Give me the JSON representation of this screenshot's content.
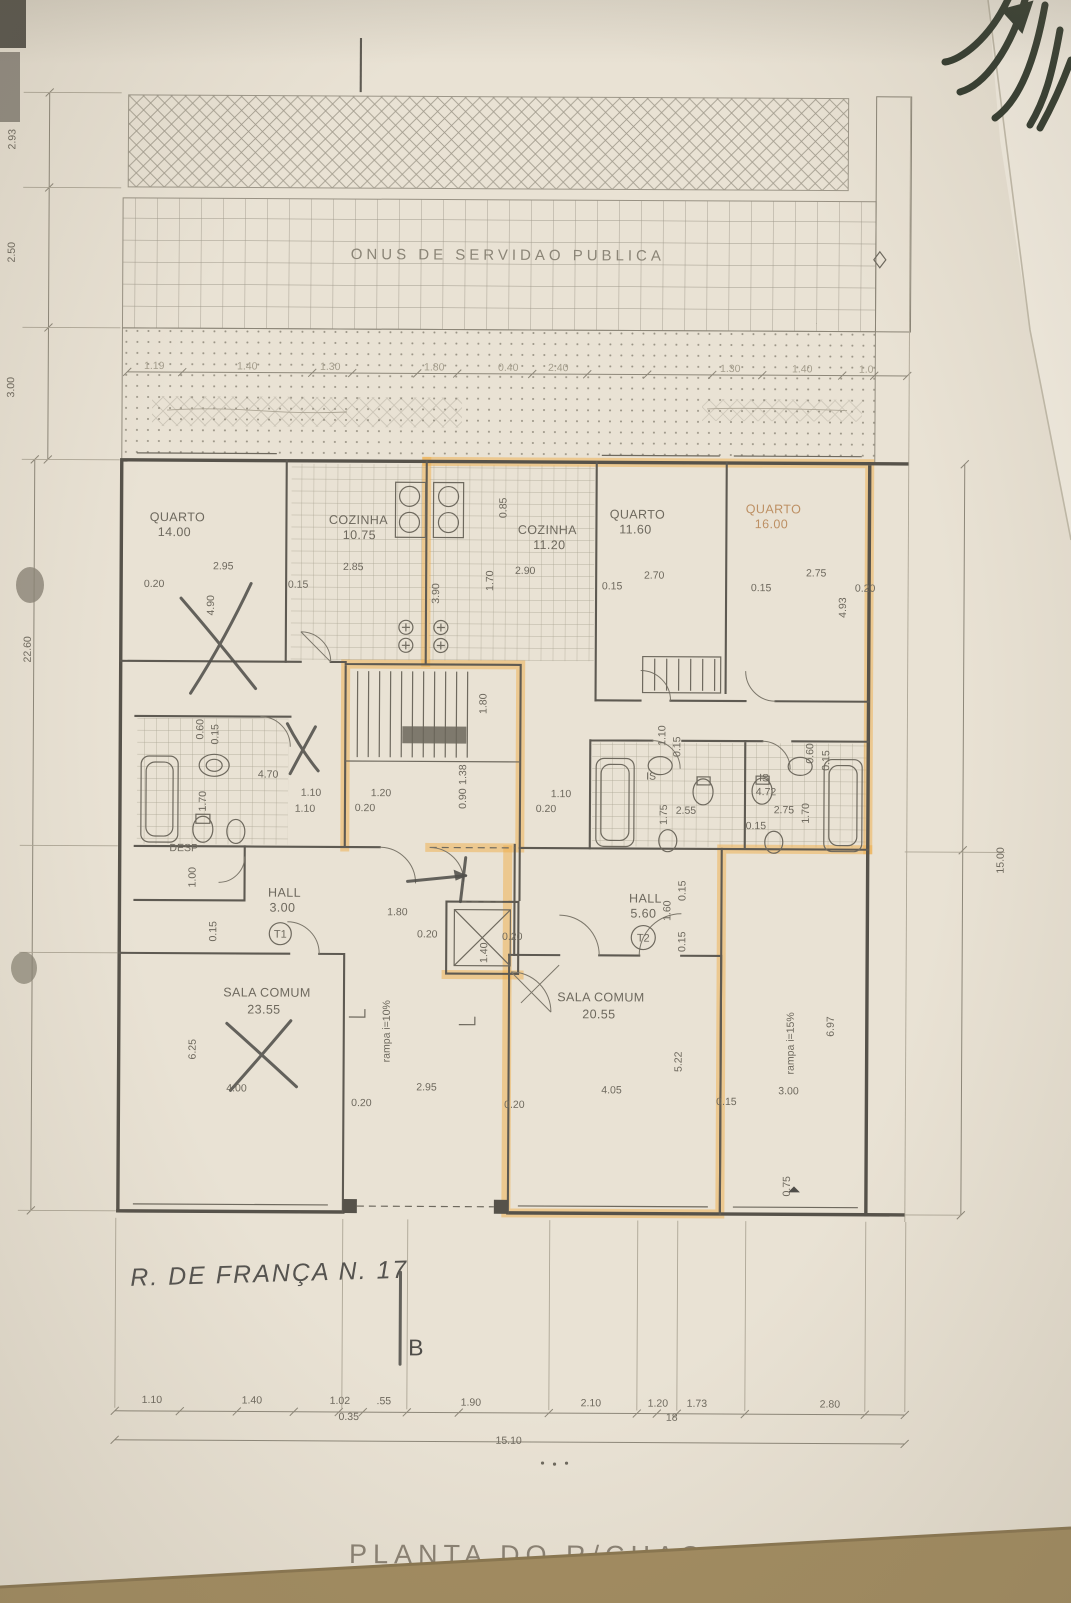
{
  "colors": {
    "paper": "#e9e2d4",
    "ink": "#6e695e",
    "wall_line": "#56524a",
    "highlighter": "#efae49",
    "pencil_mark": "#504e4a",
    "table_band": "#a28c60"
  },
  "stamps": {
    "servitude_band": "ONUS DE SERVIDAO PUBLICA",
    "sheet_title": "PLANTA DO R/CHAO"
  },
  "handwriting": {
    "street_note": "R. DE FRANÇA N. 17",
    "section_marker": "B"
  },
  "units": [
    {
      "id": "T1"
    },
    {
      "id": "T2"
    }
  ],
  "rooms": [
    {
      "name": "QUARTO",
      "area": "14.00"
    },
    {
      "name": "COZINHA",
      "area": "10.75"
    },
    {
      "name": "COZINHA",
      "area": "11.20"
    },
    {
      "name": "QUARTO",
      "area": "11.60"
    },
    {
      "name": "QUARTO",
      "area": "16.00"
    },
    {
      "name": "SALA COMUM",
      "area": "23.55"
    },
    {
      "name": "SALA COMUM",
      "area": "20.55"
    },
    {
      "name": "HALL",
      "area": "3.00"
    },
    {
      "name": "HALL",
      "area": "5.60"
    },
    {
      "name": "DESP",
      "area": ""
    },
    {
      "name": "IS",
      "area": ""
    },
    {
      "name": "IS",
      "area": "4.72"
    }
  ],
  "ramps": [
    {
      "label": "rampa i=10%"
    },
    {
      "label": "rampa i=15%"
    }
  ],
  "dimensions": {
    "totals": {
      "bottom_width": "15.10",
      "right_height": "15.00",
      "left_height": "22.60"
    },
    "chain_values": [
      {
        "t": "1.19",
        "x": 152,
        "y": 371,
        "f": 1
      },
      {
        "t": "1.40",
        "x": 245,
        "y": 371,
        "f": 1
      },
      {
        "t": "1.30",
        "x": 328,
        "y": 371,
        "f": 1
      },
      {
        "t": "1.80",
        "x": 432,
        "y": 371,
        "f": 1
      },
      {
        "t": "0.40",
        "x": 506,
        "y": 371,
        "f": 1
      },
      {
        "t": "2.40",
        "x": 556,
        "y": 371,
        "f": 1
      },
      {
        "t": "1.30",
        "x": 728,
        "y": 371,
        "f": 1
      },
      {
        "t": "1.40",
        "x": 800,
        "y": 371,
        "f": 1
      },
      {
        "t": "1.0",
        "x": 864,
        "y": 371,
        "f": 1
      },
      {
        "t": "2.93",
        "x": 12,
        "y": 142,
        "r": -90
      },
      {
        "t": "2.50",
        "x": 12,
        "y": 255,
        "r": -90
      },
      {
        "t": "3.00",
        "x": 12,
        "y": 390,
        "r": -90
      },
      {
        "t": "0.20",
        "x": 153,
        "y": 589
      },
      {
        "t": "2.95",
        "x": 222,
        "y": 571
      },
      {
        "t": "4.90",
        "x": 213,
        "y": 607,
        "r": -90
      },
      {
        "t": "0.15",
        "x": 297,
        "y": 589
      },
      {
        "t": "2.85",
        "x": 352,
        "y": 571
      },
      {
        "t": "3.90",
        "x": 438,
        "y": 594,
        "r": -90
      },
      {
        "t": "1.70",
        "x": 492,
        "y": 581,
        "r": -90
      },
      {
        "t": "2.90",
        "x": 524,
        "y": 574
      },
      {
        "t": "0.85",
        "x": 505,
        "y": 508,
        "r": -90
      },
      {
        "t": "0.15",
        "x": 611,
        "y": 589
      },
      {
        "t": "2.70",
        "x": 653,
        "y": 578
      },
      {
        "t": "2.75",
        "x": 815,
        "y": 575
      },
      {
        "t": "0.15",
        "x": 760,
        "y": 590
      },
      {
        "t": "0.20",
        "x": 864,
        "y": 590
      },
      {
        "t": "4.93",
        "x": 845,
        "y": 606,
        "r": -90
      },
      {
        "t": "0.60",
        "x": 203,
        "y": 731,
        "r": -90
      },
      {
        "t": "0.15",
        "x": 218,
        "y": 736,
        "r": -90
      },
      {
        "t": "1.70",
        "x": 206,
        "y": 803,
        "r": -90
      },
      {
        "t": "4.70",
        "x": 268,
        "y": 779
      },
      {
        "t": "1.10",
        "x": 305,
        "y": 813
      },
      {
        "t": "1.00",
        "x": 196,
        "y": 879,
        "r": -90
      },
      {
        "t": "0.15",
        "x": 217,
        "y": 933,
        "r": -90
      },
      {
        "t": "1.80",
        "x": 486,
        "y": 704,
        "r": -90
      },
      {
        "t": "1.38",
        "x": 466,
        "y": 775,
        "r": -90
      },
      {
        "t": "0.90",
        "x": 466,
        "y": 799,
        "r": -90
      },
      {
        "t": "1.20",
        "x": 381,
        "y": 797
      },
      {
        "t": "0.20",
        "x": 365,
        "y": 812
      },
      {
        "t": "1.10",
        "x": 311,
        "y": 797
      },
      {
        "t": "1.10",
        "x": 561,
        "y": 797
      },
      {
        "t": "0.20",
        "x": 546,
        "y": 812
      },
      {
        "t": "1.10",
        "x": 665,
        "y": 735,
        "r": -90
      },
      {
        "t": "0.15",
        "x": 680,
        "y": 746,
        "r": -90
      },
      {
        "t": "2.55",
        "x": 686,
        "y": 813
      },
      {
        "t": "1.75",
        "x": 667,
        "y": 814,
        "r": -90
      },
      {
        "t": "0.15",
        "x": 756,
        "y": 828
      },
      {
        "t": "2.75",
        "x": 784,
        "y": 812
      },
      {
        "t": "1.70",
        "x": 809,
        "y": 812,
        "r": -90
      },
      {
        "t": "0.60",
        "x": 813,
        "y": 752,
        "r": -90
      },
      {
        "t": "0.15",
        "x": 829,
        "y": 759,
        "r": -90
      },
      {
        "t": "1.60",
        "x": 671,
        "y": 910,
        "r": -90
      },
      {
        "t": "0.15",
        "x": 686,
        "y": 890,
        "r": -90
      },
      {
        "t": "0.15",
        "x": 686,
        "y": 941,
        "r": -90
      },
      {
        "t": "1.80",
        "x": 398,
        "y": 916
      },
      {
        "t": "0.20",
        "x": 428,
        "y": 938
      },
      {
        "t": "1.40",
        "x": 488,
        "y": 953,
        "r": -90
      },
      {
        "t": "0.20",
        "x": 513,
        "y": 940
      },
      {
        "t": "6.25",
        "x": 197,
        "y": 1051,
        "r": -90
      },
      {
        "t": "4.00",
        "x": 238,
        "y": 1093
      },
      {
        "t": "0.20",
        "x": 363,
        "y": 1107
      },
      {
        "t": "2.95",
        "x": 428,
        "y": 1091
      },
      {
        "t": "0.20",
        "x": 516,
        "y": 1108
      },
      {
        "t": "4.05",
        "x": 613,
        "y": 1093
      },
      {
        "t": "5.22",
        "x": 683,
        "y": 1061,
        "r": -90
      },
      {
        "t": "0.15",
        "x": 728,
        "y": 1104
      },
      {
        "t": "3.00",
        "x": 790,
        "y": 1093
      },
      {
        "t": "6.97",
        "x": 835,
        "y": 1025,
        "r": -90
      },
      {
        "t": "0.75",
        "x": 792,
        "y": 1185,
        "r": -90
      },
      {
        "t": "1.10",
        "x": 155,
        "y": 1405
      },
      {
        "t": "1.40",
        "x": 255,
        "y": 1405
      },
      {
        "t": "1.02",
        "x": 343,
        "y": 1405
      },
      {
        "t": ".55",
        "x": 387,
        "y": 1405
      },
      {
        "t": "1.90",
        "x": 474,
        "y": 1406
      },
      {
        "t": "2.10",
        "x": 594,
        "y": 1406
      },
      {
        "t": "1.20",
        "x": 661,
        "y": 1406
      },
      {
        "t": "1.73",
        "x": 700,
        "y": 1406
      },
      {
        "t": "2.80",
        "x": 833,
        "y": 1406
      },
      {
        "t": "0.35",
        "x": 352,
        "y": 1421
      },
      {
        "t": "18",
        "x": 675,
        "y": 1420
      }
    ]
  }
}
